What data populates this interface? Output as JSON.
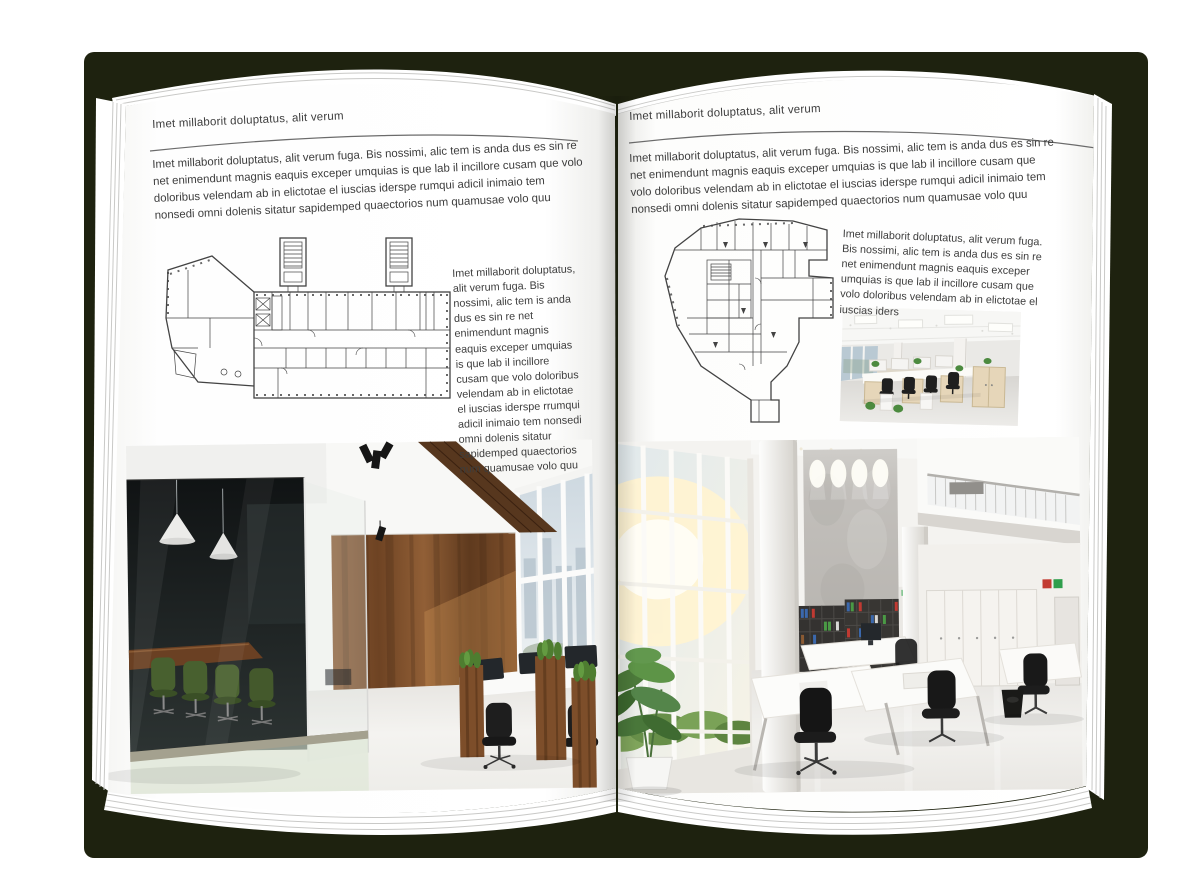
{
  "document_type": "interior-design brochure spread mockup",
  "background_color": "#ffffff",
  "cover_color": "#1e220f",
  "page_color": "#ffffff",
  "left_page": {
    "header": "Imet millaborit doluptatus, alit verum",
    "intro": "Imet millaborit doluptatus, alit verum fuga. Bis nossimi, alic tem is anda dus es sin re net enimendunt magnis eaquis exceper umquias is que lab il incillore cusam que volo doloribus velendam ab in elictotae el iuscias iderspe rumqui adicil inimaio tem nonsedi omni dolenis sitatur sapidemped quaectorios num quamusae volo quu",
    "side_text": "Imet millaborit doluptatus, alit verum fuga. Bis nossimi, alic tem is anda dus es sin re net enimendunt magnis eaquis exceper umquias is que lab il incillore cusam que volo doloribus velendam ab in elictotae el iuscias iderspe rrumqui adicil inimaio tem nonsedi omni dolenis sitatur sapidemped quaectorios num quamusae volo quu",
    "figures": {
      "floor_plan": "architectural floor plan drawing with stair towers",
      "photo": "open office interior with dark glass meeting room, wood wall and planter desks"
    }
  },
  "right_page": {
    "header": "Imet millaborit doluptatus, alit verum",
    "intro": "Imet millaborit doluptatus, alit verum fuga. Bis nossimi, alic tem is anda dus es sin re net enimendunt magnis eaquis exceper umquias is que lab il incillore cusam que volo doloribus velendam ab in elictotae el iuscias iderspe rumqui adicil inimaio tem nonsedi omni dolenis sitatur sapidemped quaectorios num quamusae volo quu",
    "side_text": "Imet millaborit doluptatus, alit verum fuga. Bis nossimi, alic tem is anda dus es sin re net enimendunt magnis eaquis exceper umquias is que lab il incillore cusam que volo doloribus velendam ab in elictotae el iuscias iders",
    "figures": {
      "floor_plan": "irregular building floor plan drawing",
      "photo_small": "open plan office with light wood workstations",
      "photo_large": "double height white office atrium with binder shelf wall"
    }
  }
}
